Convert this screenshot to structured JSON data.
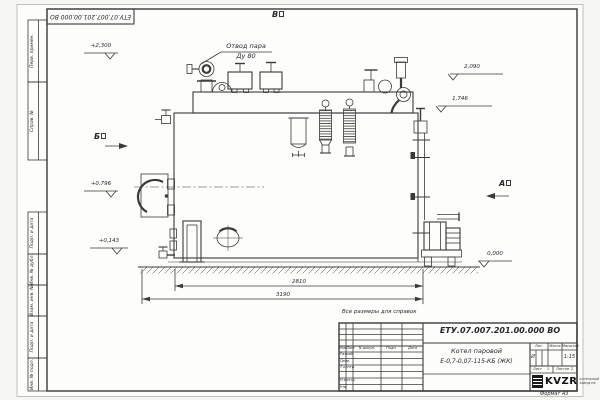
{
  "sheet": {
    "top_stamp": "ЕТУ.07.007.201.00.000 ВО",
    "reference_note": "Все размеры для справок",
    "format_label": "Формат А3"
  },
  "frame_strips": [
    "Перв. примен.",
    "Справ. №",
    "Подп. и дата",
    "Инв. № дубл.",
    "Взам. инв. №",
    "Подп. и дата",
    "Инв. № подл."
  ],
  "views": {
    "top": "В",
    "left": "Б",
    "right": "А"
  },
  "elevations": [
    "+2,300",
    "2,090",
    "1,746",
    "+0,796",
    "+0,143",
    "0,000"
  ],
  "callout": {
    "line1": "Отвод пара",
    "line2": "Ду 80"
  },
  "dimensions": {
    "inner": "2810",
    "overall": "3190"
  },
  "title_block": {
    "doc_number": "ЕТУ.07.007.201.00.000 ВО",
    "product_line1": "Котел паровой",
    "product_line2": "Е-0,7-0,07-115-КБ (ЖК)",
    "col_izm": "Изм.",
    "col_list": "Лист",
    "col_doc": "N докум.",
    "col_sign": "Подп.",
    "col_date": "Дата",
    "rows": [
      "Разраб.",
      "Пров.",
      "Т.контр.",
      "Н.контр.",
      "Утв."
    ],
    "lit_label": "Лит.",
    "mass_label": "Масса",
    "scale_label": "Масштаб",
    "lit_value": "И",
    "scale_value": "1:15",
    "sheet_label": "Лист",
    "sheet_value": "1",
    "sheets_label": "Листов",
    "sheets_value": "2",
    "logo_text": "KVZR",
    "logo_caption1": "КОТЕЛЬНЫЙ",
    "logo_caption2": "ЗАВОД РФ"
  }
}
